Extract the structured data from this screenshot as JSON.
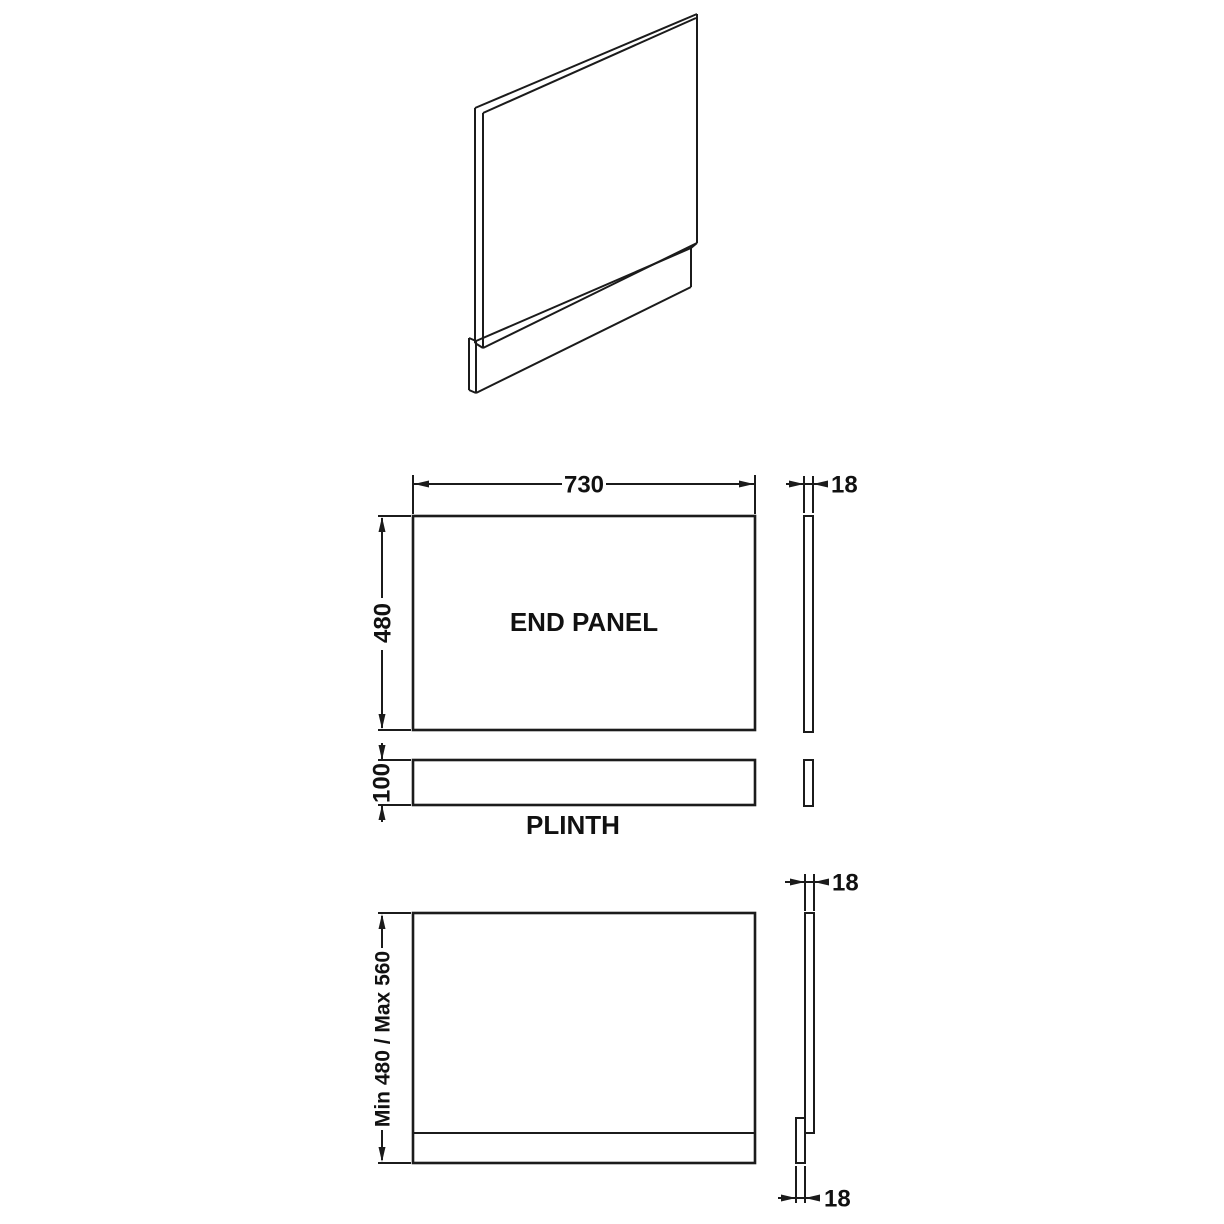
{
  "drawing": {
    "background_color": "#ffffff",
    "line_color": "#1b1b1b",
    "text_color": "#111111"
  },
  "views": {
    "end_panel_front": {
      "label": "END PANEL",
      "width": "730",
      "height": "480"
    },
    "end_panel_side": {
      "thickness": "18"
    },
    "plinth_front": {
      "label": "PLINTH",
      "height": "100"
    },
    "assembled_front": {
      "height_range": "Min 480 / Max 560"
    },
    "assembled_side": {
      "panel_thickness": "18",
      "plinth_thickness": "18"
    }
  }
}
